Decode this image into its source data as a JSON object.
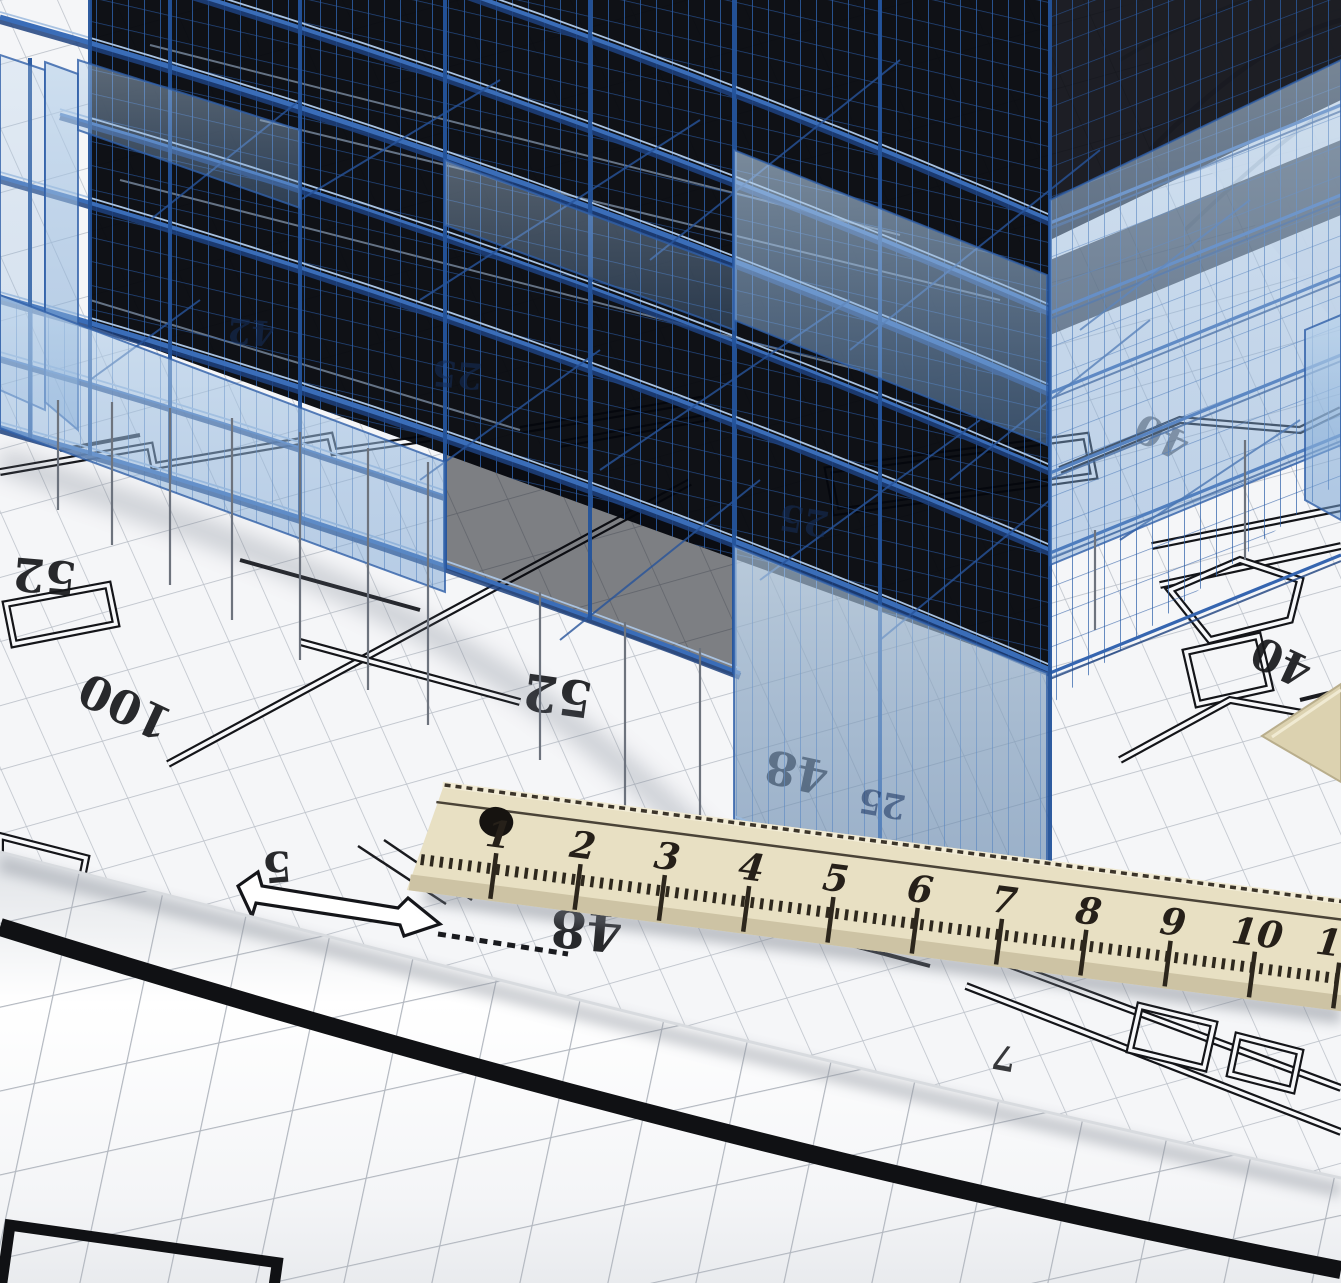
{
  "scene": {
    "description": "Semi-transparent blue 3D wireframe building model standing on an architectural blueprint floor plan drawn on grid paper, with a wooden ruler lying diagonally across and a rolled drawing sheet in the foreground",
    "objects": [
      "wireframe-building",
      "blueprint-floor-plan",
      "wooden-ruler",
      "rolled-sheet",
      "set-square-corner",
      "dimension-arrow"
    ]
  },
  "blueprint": {
    "dimension_labels": [
      {
        "text": "52",
        "x": 46,
        "y": 560,
        "rot": 185,
        "size": 46,
        "opacity": 0.92
      },
      {
        "text": "100",
        "x": 132,
        "y": 692,
        "rot": 205,
        "size": 46,
        "opacity": 0.92
      },
      {
        "text": "52",
        "x": 560,
        "y": 678,
        "rot": 188,
        "size": 50,
        "opacity": 0.92
      },
      {
        "text": "48",
        "x": 800,
        "y": 756,
        "rot": 192,
        "size": 46,
        "opacity": 0.92
      },
      {
        "text": "40",
        "x": 1288,
        "y": 648,
        "rot": 205,
        "size": 44,
        "opacity": 0.92
      },
      {
        "text": "5",
        "x": 276,
        "y": 852,
        "rot": 175,
        "size": 42,
        "opacity": 0.92
      },
      {
        "text": "48",
        "x": 588,
        "y": 912,
        "rot": 185,
        "size": 52,
        "opacity": 0.92
      },
      {
        "text": "7",
        "x": 1006,
        "y": 1046,
        "rot": 190,
        "size": 34,
        "opacity": 0.85
      },
      {
        "text": "40",
        "x": 1168,
        "y": 424,
        "rot": 205,
        "size": 40,
        "opacity": 0.55
      }
    ]
  },
  "building": {
    "glass_labels": [
      {
        "text": "42",
        "x": 252,
        "y": 320,
        "rot": 185,
        "size": 34
      },
      {
        "text": "25",
        "x": 458,
        "y": 362,
        "rot": 185,
        "size": 36
      },
      {
        "text": "25",
        "x": 806,
        "y": 508,
        "rot": 190,
        "size": 36
      },
      {
        "text": "25",
        "x": 884,
        "y": 792,
        "rot": 190,
        "size": 34
      }
    ]
  },
  "ruler": {
    "numbers": [
      "1",
      "2",
      "3",
      "4",
      "5",
      "6",
      "7",
      "8",
      "9",
      "10",
      "11"
    ]
  },
  "colors": {
    "wireframe_blue": "#3a6db8",
    "wireframe_dark": "#24549c",
    "glass_blue": "#9dbfe2",
    "void_black": "#05070d",
    "paper_white": "#f6f7f9",
    "grid_gray": "#bcc1c9",
    "ruler_wood": "#e8e0c3",
    "ink_black": "#17181b"
  }
}
